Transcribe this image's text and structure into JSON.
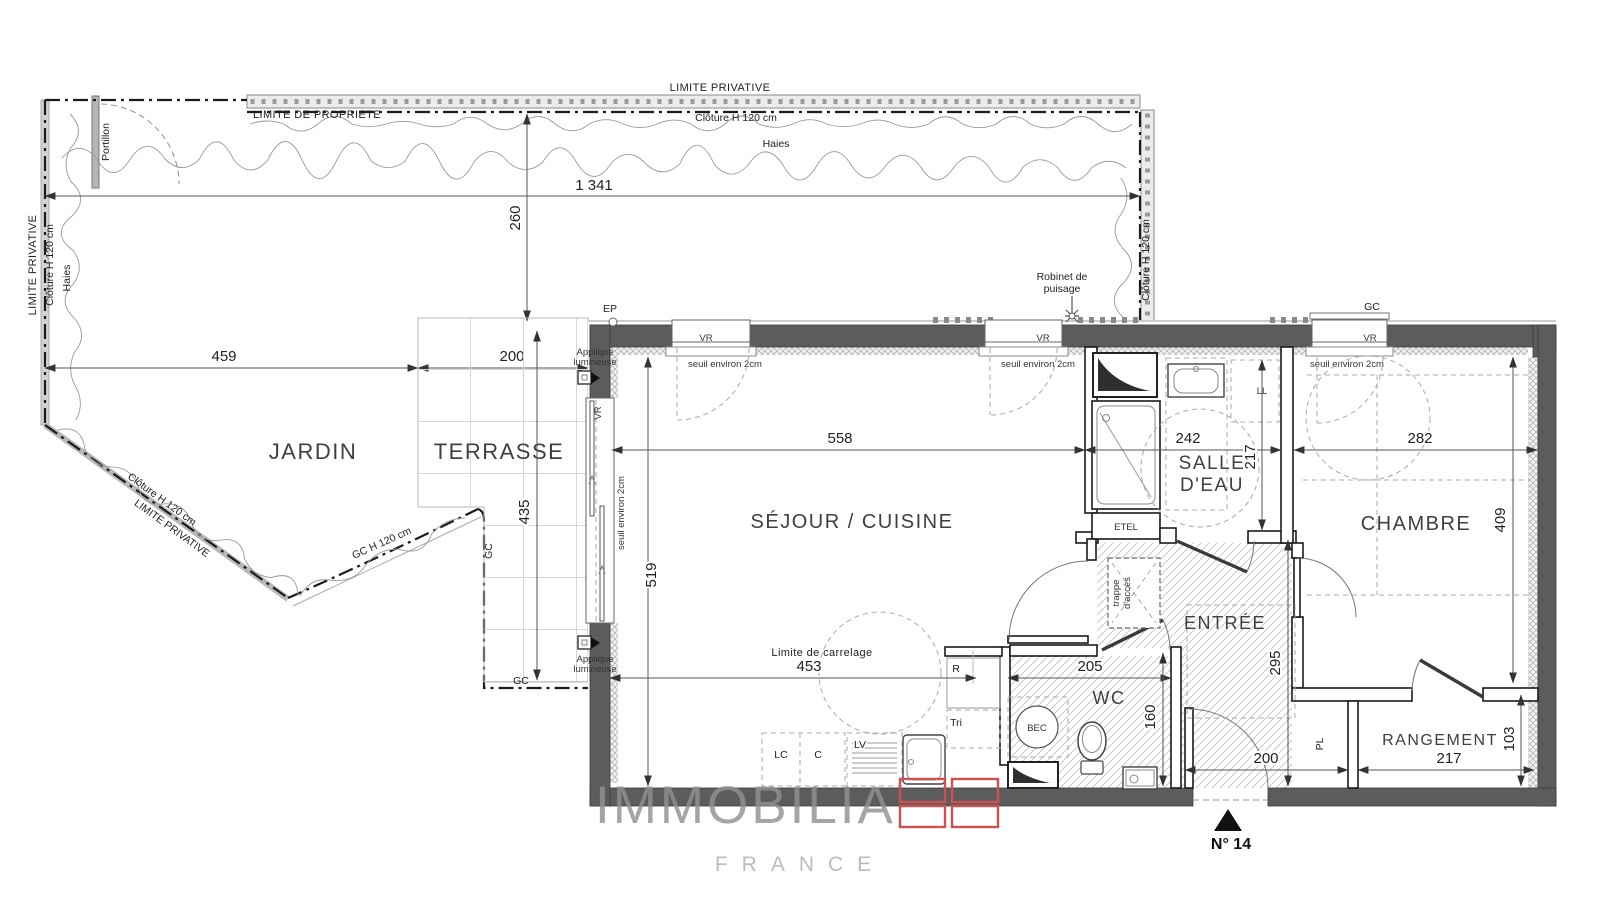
{
  "colors": {
    "wall_gray": "#5c5c5c",
    "accent_red": "#d05050",
    "floor_hatch": "#c9c9c9",
    "boundary": "#1b1b1b"
  },
  "logo": {
    "brand": "IMMOBILIA",
    "country": "FRANCE",
    "unit_number": "N° 14"
  },
  "rooms": {
    "jardin": "JARDIN",
    "terrasse": "TERRASSE",
    "sejour_cuisine": "SÉJOUR / CUISINE",
    "salle_deau_line1": "SALLE",
    "salle_deau_line2": "D'EAU",
    "chambre": "CHAMBRE",
    "entree": "ENTRÉE",
    "wc": "WC",
    "rangement": "RANGEMENT"
  },
  "dimensions_cm": {
    "garden_total_width": "1 341",
    "garden_left_width": "459",
    "terrace_width": "200",
    "garden_depth": "260",
    "terrace_depth": "435",
    "sejour_width": "558",
    "sejour_depth": "519",
    "salle_deau_width": "242",
    "salle_deau_depth": "217",
    "chambre_width": "282",
    "chambre_depth": "409",
    "carrelage_width": "453",
    "wc_width": "205",
    "wc_depth": "160",
    "entree_depth": "295",
    "entree_width": "200",
    "rangement_width": "217",
    "rangement_depth": "103"
  },
  "boundaries": {
    "limite_privative": "LIMITE PRIVATIVE",
    "limite_de_propriete": "LIMITE DE PROPRIETE",
    "cloture": "Clôture H 120 cm",
    "haies": "Haies",
    "portillon": "Portillon",
    "gc_fence": "GC H 120 cm"
  },
  "annotations": {
    "ep": "EP",
    "gc": "GC",
    "vr": "VR",
    "seuil": "seuil environ 2cm",
    "robinet_line1": "Robinet de",
    "robinet_line2": "puisage",
    "applique_line1": "Applique",
    "applique_line2": "lumineuse",
    "limite_carrelage": "Limite de carrelage",
    "trappe_line1": "trappe",
    "trappe_line2": "d'accès",
    "etel": "ETEL",
    "ll": "LL",
    "bec": "BEC",
    "pl": "PL",
    "r": "R",
    "tri": "Tri",
    "lc": "LC",
    "c": "C",
    "lv": "LV"
  }
}
